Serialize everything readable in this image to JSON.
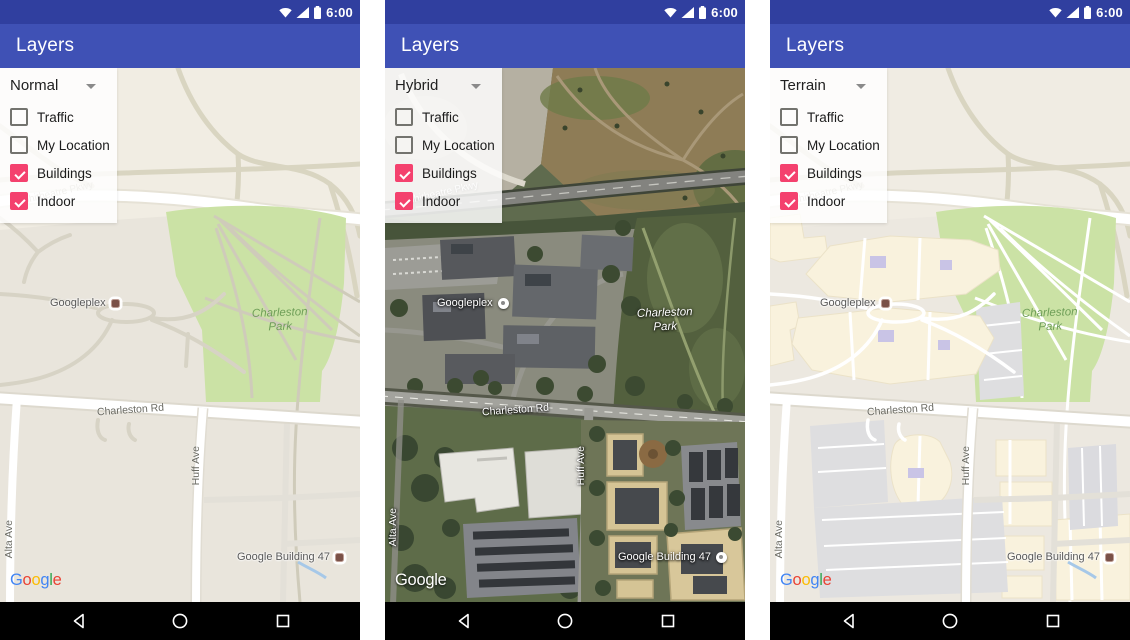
{
  "shared": {
    "status_bar": {
      "time": "6:00"
    },
    "app_bar": {
      "title": "Layers"
    },
    "panel": {
      "checkboxes": [
        {
          "label": "Traffic",
          "checked": false
        },
        {
          "label": "My Location",
          "checked": false
        },
        {
          "label": "Buildings",
          "checked": true
        },
        {
          "label": "Indoor",
          "checked": true
        }
      ]
    },
    "map_labels": {
      "googleplex": "Googleplex",
      "charleston_park_line1": "Charleston",
      "charleston_park_line2": "Park",
      "charleston_rd": "Charleston Rd",
      "huff_ave": "Huff Ave",
      "alta_ave": "Alta Ave",
      "google_building_47": "Google Building 47",
      "amphitheatre_pkwy": "Amphitheatre Pkwy"
    },
    "logo": {
      "letters": [
        "G",
        "o",
        "o",
        "g",
        "l",
        "e"
      ],
      "colors": [
        "#4285F4",
        "#EA4335",
        "#FBBC05",
        "#4285F4",
        "#34A853",
        "#EA4335"
      ]
    },
    "icons": [
      "wifi-icon",
      "cellular-icon",
      "battery-icon",
      "chevron-down-icon",
      "back-icon",
      "home-icon",
      "recents-icon"
    ],
    "colors": {
      "status_bar": "#303F9F",
      "app_bar": "#3F51B5",
      "checkbox_accent": "#F4416E",
      "nav_bar": "#000000",
      "park_green": "#CBE2A5",
      "map_beige": "#EFEBE2"
    }
  },
  "phones": [
    {
      "map_type": "Normal"
    },
    {
      "map_type": "Hybrid"
    },
    {
      "map_type": "Terrain"
    }
  ]
}
